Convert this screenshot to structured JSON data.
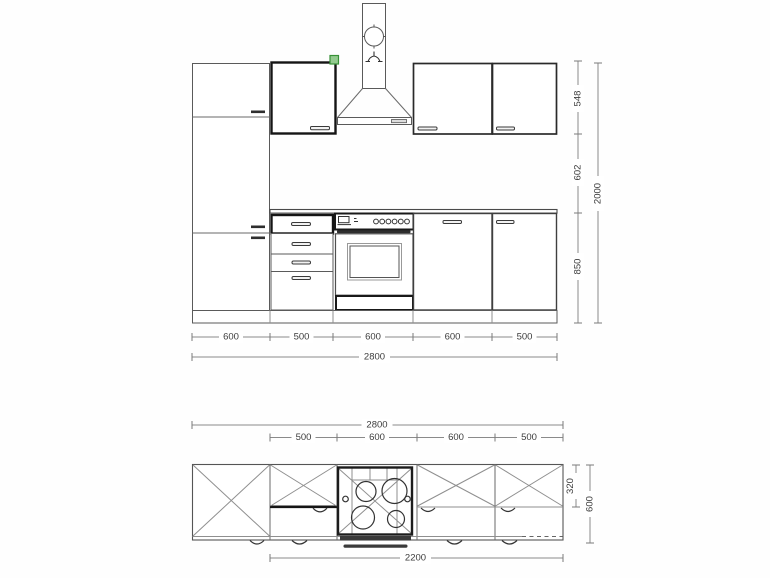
{
  "drawing": {
    "title": "kitchen-block-technical-drawing",
    "front_view": {
      "width_segments": [
        "600",
        "500",
        "600",
        "600",
        "500"
      ],
      "total_width": "2800",
      "wall_cabinet_height": "548",
      "mid_gap": "602",
      "base_height": "850",
      "total_height": "2000"
    },
    "plan_view": {
      "total_width": "2800",
      "width_segments": [
        "500",
        "600",
        "600",
        "500"
      ],
      "wall_depth": "320",
      "total_depth": "600",
      "run_width": "2200"
    },
    "colors": {
      "selection_fill": "#93cb8f",
      "selection_border": "#379137",
      "line": "#5a5a5a",
      "highlight": "#151515"
    }
  }
}
